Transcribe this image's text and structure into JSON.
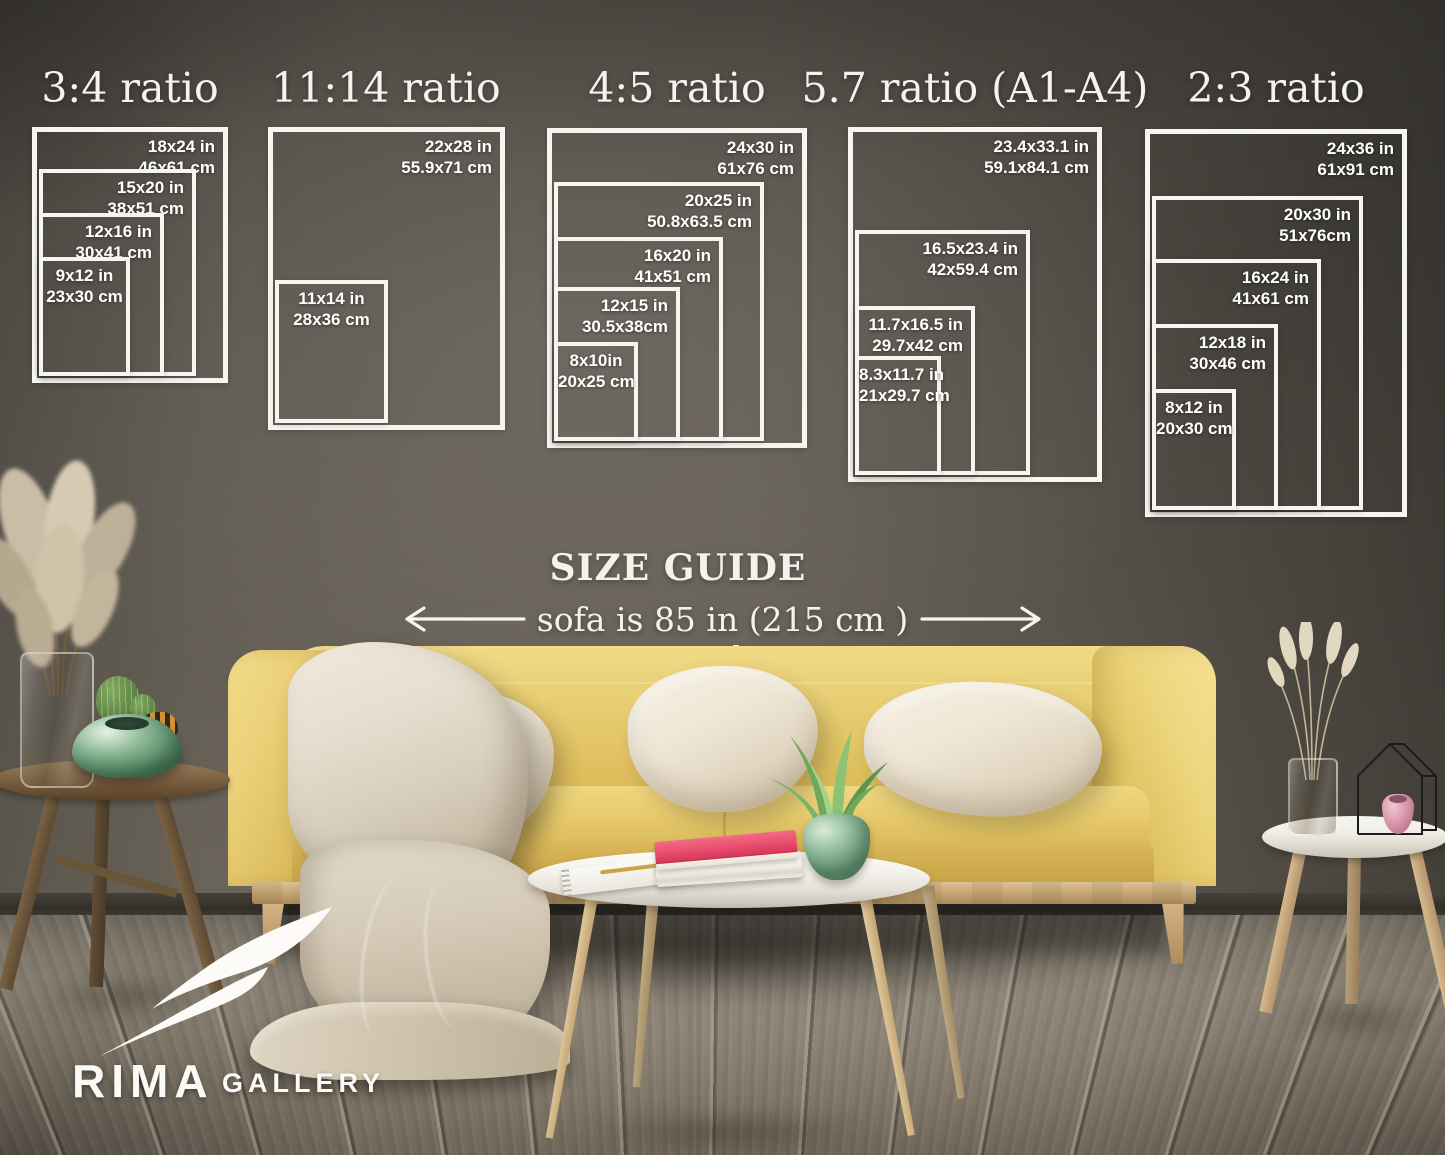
{
  "poster": {
    "heading": "SIZE GUIDE",
    "sofa_width_note": "sofa is 85 in (215 cm ) wide",
    "brand": {
      "name": "RIMA",
      "suffix": "GALLERY"
    },
    "colors": {
      "wall": "#615d55",
      "floor": "#857d70",
      "sofa_yellow": "#e6c76a",
      "pillow_cream": "#ece3d2",
      "blanket_beige": "#d8d0c0",
      "table_white": "#f4f2ec",
      "wood_light": "#cdab7c",
      "wood_dark": "#6e5738",
      "book_pink": "#e8436f",
      "vase_green": "#7fae8d",
      "text_white": "#f6f4ef"
    },
    "groups": [
      {
        "title": "3:4 ratio",
        "frames": [
          {
            "inches": "18x24 in",
            "cm": "46x61 cm"
          },
          {
            "inches": "15x20 in",
            "cm": "38x51 cm"
          },
          {
            "inches": "12x16 in",
            "cm": "30x41 cm"
          },
          {
            "inches": "9x12 in",
            "cm": "23x30 cm"
          }
        ]
      },
      {
        "title": "11:14 ratio",
        "frames": [
          {
            "inches": "22x28 in",
            "cm": "55.9x71 cm"
          },
          {
            "inches": "11x14 in",
            "cm": "28x36 cm"
          }
        ]
      },
      {
        "title": "4:5 ratio",
        "frames": [
          {
            "inches": "24x30 in",
            "cm": "61x76 cm"
          },
          {
            "inches": "20x25 in",
            "cm": "50.8x63.5 cm"
          },
          {
            "inches": "16x20 in",
            "cm": "41x51 cm"
          },
          {
            "inches": "12x15 in",
            "cm": "30.5x38cm"
          },
          {
            "inches": "8x10in",
            "cm": "20x25 cm"
          }
        ]
      },
      {
        "title": "5.7 ratio (A1-A4)",
        "frames": [
          {
            "inches": "23.4x33.1 in",
            "cm": "59.1x84.1 cm"
          },
          {
            "inches": "16.5x23.4 in",
            "cm": "42x59.4 cm"
          },
          {
            "inches": "11.7x16.5 in",
            "cm": "29.7x42 cm"
          },
          {
            "inches": "8.3x11.7 in",
            "cm": "21x29.7 cm"
          }
        ]
      },
      {
        "title": "2:3 ratio",
        "frames": [
          {
            "inches": "24x36 in",
            "cm": "61x91 cm"
          },
          {
            "inches": "20x30 in",
            "cm": "51x76cm"
          },
          {
            "inches": "16x24 in",
            "cm": "41x61 cm"
          },
          {
            "inches": "12x18 in",
            "cm": "30x46 cm"
          },
          {
            "inches": "8x12 in",
            "cm": "20x30 cm"
          }
        ]
      }
    ]
  }
}
